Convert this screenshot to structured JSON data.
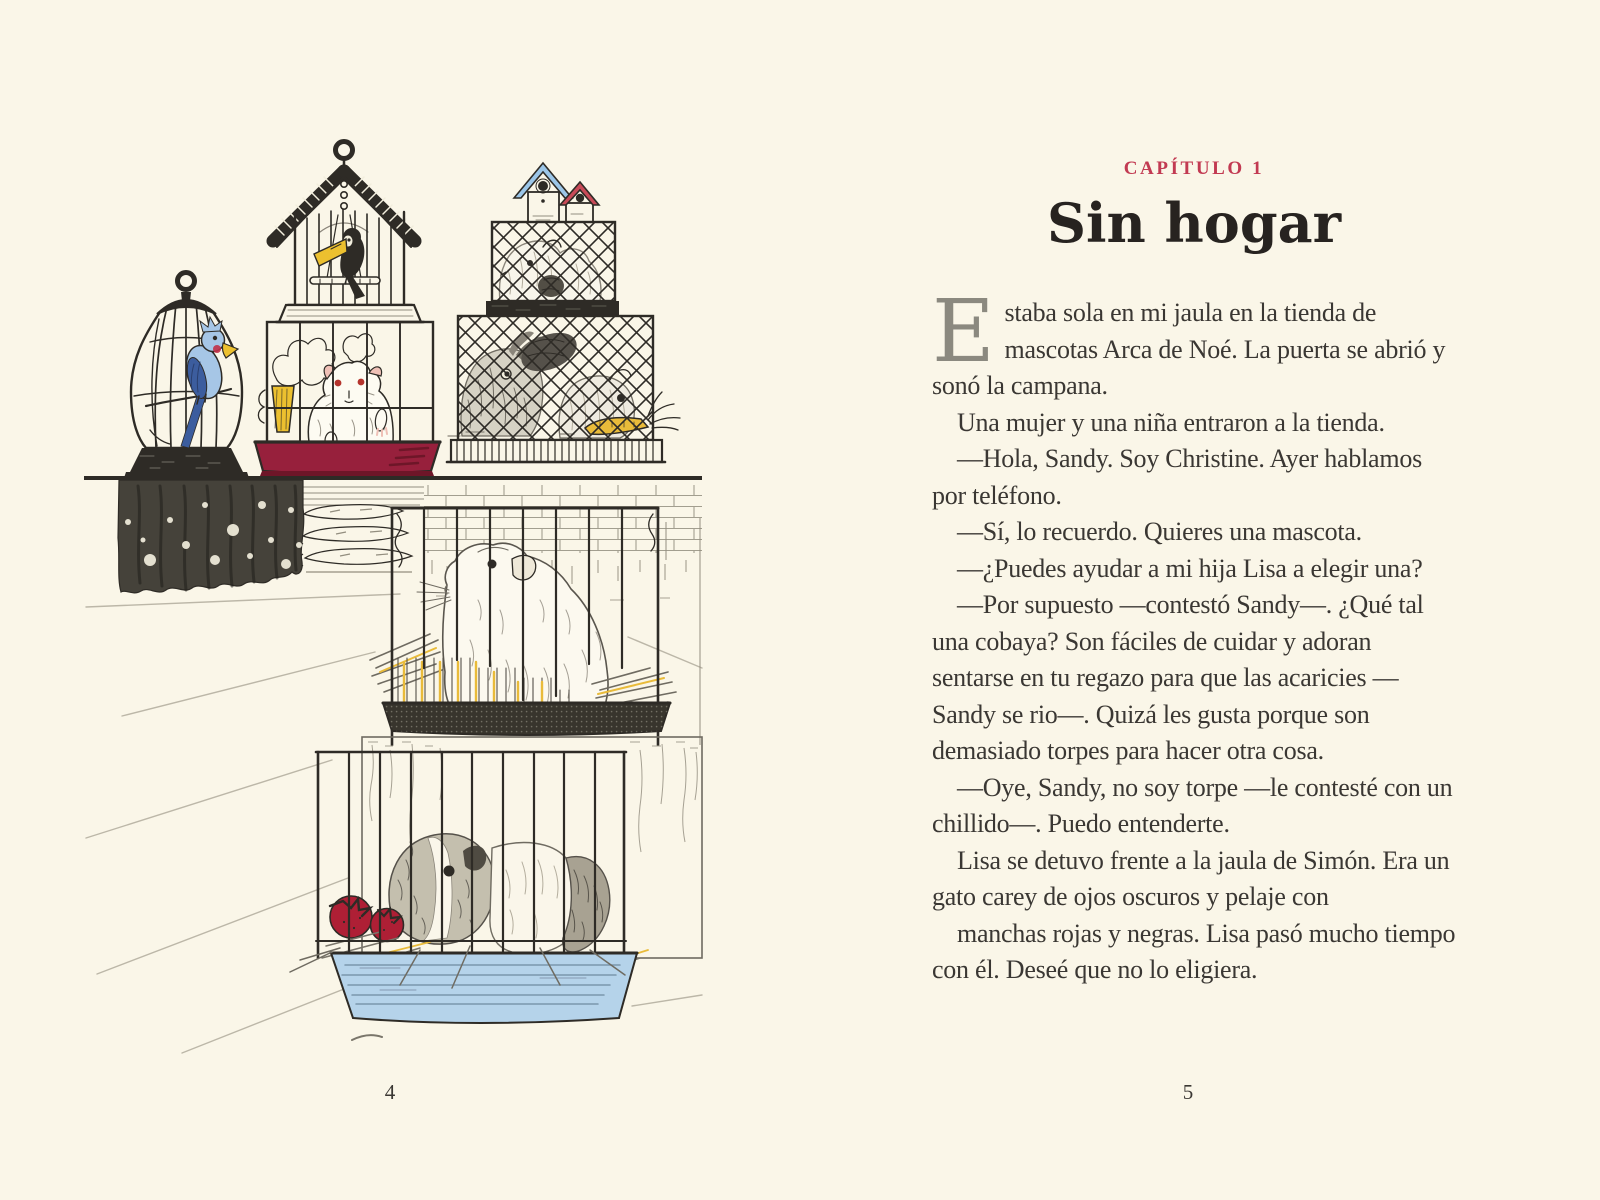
{
  "palette": {
    "paper": "#faf6e8",
    "ink": "#2e2b26",
    "wood_line": "#938e7f",
    "floor_line": "#bcb7a8",
    "chapter_red": "#c23a52",
    "title_ink": "#272320",
    "body_ink": "#3a3733",
    "dropcap_gray": "#8b897f",
    "parrot_light": "#a6c6e6",
    "parrot_dark": "#3c5d9e",
    "beak_yellow": "#ecc02f",
    "cheek_red": "#c13048",
    "eye_red": "#b5342d",
    "ear_pink": "#efc0b6",
    "tray_red": "#97203c",
    "tray_red_dark": "#6e1628",
    "tray_blue": "#b5d3ea",
    "tray_blue_line": "#7b97ad",
    "roof_blue": "#9cc6e8",
    "roof_red": "#c84a58",
    "carrot_yellow": "#e9bb3a",
    "tomato_red": "#ae1f35",
    "curtain_dark": "#45423a",
    "cream": "#f2eedd"
  },
  "left_page": {
    "page_number": "4",
    "illustration": {
      "name": "pet-shop-cages",
      "alt": "Ilustración de una tienda de mascotas con jaulas: un periquito azul, un tucán, un hámster blanco, conejos y dos cobayas"
    }
  },
  "right_page": {
    "page_number": "5",
    "kicker": "CAPÍTULO 1",
    "title": "Sin hogar",
    "drop_cap": "E",
    "paragraphs": [
      {
        "indent": false,
        "drop_cap": true,
        "text": "staba sola en mi jaula en la tienda de mascotas Arca de Noé. La puerta se abrió y sonó la campana."
      },
      {
        "indent": true,
        "drop_cap": false,
        "text": "Una mujer y una niña entraron a la tienda."
      },
      {
        "indent": true,
        "drop_cap": false,
        "text": "—Hola, Sandy. Soy Christine. Ayer hablamos por teléfono."
      },
      {
        "indent": true,
        "drop_cap": false,
        "text": "—Sí, lo recuerdo. Quieres una mascota."
      },
      {
        "indent": true,
        "drop_cap": false,
        "text": "—¿Puedes ayudar a mi hija Lisa a elegir una?"
      },
      {
        "indent": true,
        "drop_cap": false,
        "text": "—Por supuesto —contestó Sandy—. ¿Qué tal una cobaya? Son fáciles de cuidar y adoran sentarse en tu regazo para que las acaricies —Sandy se rio—. Quizá les gusta porque son demasiado torpes para hacer otra cosa."
      },
      {
        "indent": true,
        "drop_cap": false,
        "text": "—Oye, Sandy, no soy torpe —le contesté con un chillido—. Puedo entenderte."
      },
      {
        "indent": true,
        "drop_cap": false,
        "text": "Lisa se detuvo frente a la jaula de Simón. Era un gato carey de ojos oscuros y pelaje con"
      },
      {
        "indent": true,
        "drop_cap": false,
        "text": "manchas rojas y negras. Lisa pasó mucho tiempo con él. Deseé que no lo eligiera."
      }
    ]
  }
}
